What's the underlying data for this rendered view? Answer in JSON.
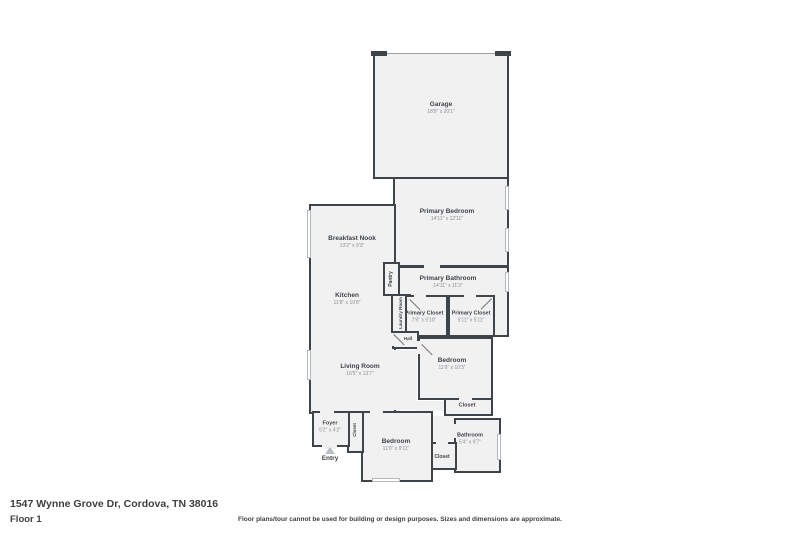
{
  "footer": {
    "address": "1547 Wynne Grove Dr, Cordova, TN 38016",
    "floor_label": "Floor 1",
    "disclaimer": "Floor plans/tour cannot be used for building or design purposes. Sizes and dimensions are approximate."
  },
  "entry_label": "Entry",
  "rooms": {
    "garage": {
      "name": "Garage",
      "dims": "18'9\" x 20'1\""
    },
    "primary_bedroom": {
      "name": "Primary Bedroom",
      "dims": "14'11\" x 12'11\""
    },
    "breakfast_nook": {
      "name": "Breakfast Nook",
      "dims": "13'2\" x 9'3\""
    },
    "pantry": {
      "name": "Pantry"
    },
    "kitchen": {
      "name": "Kitchen",
      "dims": "11'8\" x 10'8\""
    },
    "primary_bathroom": {
      "name": "Primary Bathroom",
      "dims": "14'11\" x 11'3\""
    },
    "laundry_room": {
      "name": "Laundry Room"
    },
    "primary_closet_left": {
      "name": "Primary Closet",
      "dims": "7'9\" x 5'10\""
    },
    "primary_closet_right": {
      "name": "Primary Closet",
      "dims": "5'11\" x 5'11\""
    },
    "hall": {
      "name": "Hall"
    },
    "living_room": {
      "name": "Living Room",
      "dims": "16'5\" x 13'7\""
    },
    "bedroom_2": {
      "name": "Bedroom",
      "dims": "11'6\" x 10'3\""
    },
    "closet_hall": {
      "name": "Closet"
    },
    "foyer": {
      "name": "Foyer",
      "dims": "5'2\" x 4'2\""
    },
    "closet_foyer": {
      "name": "Closet"
    },
    "bedroom_3": {
      "name": "Bedroom",
      "dims": "11'0\" x 9'11\""
    },
    "closet_bedroom": {
      "name": "Closet"
    },
    "bathroom": {
      "name": "Bathroom",
      "dims": "5'4\" x 9'7\""
    }
  },
  "colors": {
    "wall": "#3f4449",
    "floor": "#f1f1f2",
    "background": "#ffffff"
  }
}
